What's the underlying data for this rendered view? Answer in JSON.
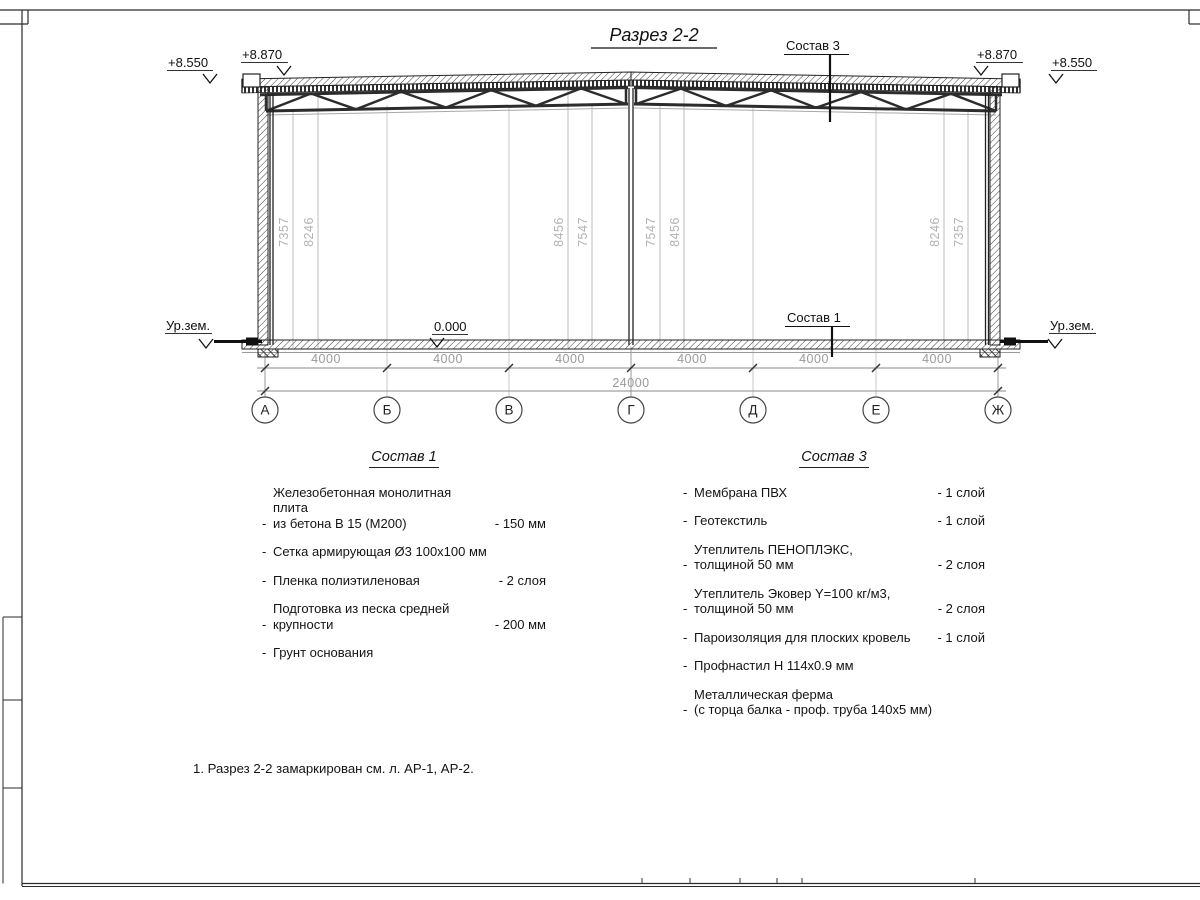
{
  "bullet": "-",
  "title": "Разрез 2-2",
  "note": "1. Разрез 2-2 замаркирован см. л. АР-1, АР-2.",
  "drawing": {
    "callout_roof": "Состав 3",
    "callout_floor": "Состав 1",
    "levels": {
      "left_outer": "+8.550",
      "left_eave": "+8.870",
      "right_eave": "+8.870",
      "right_outer": "+8.550",
      "floor": "0.000",
      "ground_left": "Ур.зем.",
      "ground_right": "Ур.зем."
    },
    "vertical_dims": [
      "7357",
      "8246",
      "8456",
      "7547",
      "7547",
      "8456",
      "8246",
      "7357"
    ],
    "bay_dims": [
      "4000",
      "4000",
      "4000",
      "4000",
      "4000",
      "4000"
    ],
    "total_dim": "24000",
    "axes": [
      "А",
      "Б",
      "В",
      "Г",
      "Д",
      "Е",
      "Ж"
    ]
  },
  "spec1": {
    "heading": "Состав 1",
    "items": [
      {
        "name": "Железобетонная  монолитная плита\nиз бетона В 15 (М200)",
        "value": "- 150 мм"
      },
      {
        "name": "Сетка армирующая Ø3 100х100 мм",
        "value": ""
      },
      {
        "name": "Пленка полиэтиленовая",
        "value": "- 2 слоя"
      },
      {
        "name": "Подготовка из песка средней\nкрупности",
        "value": "- 200 мм"
      },
      {
        "name": "Грунт основания",
        "value": ""
      }
    ]
  },
  "spec3": {
    "heading": "Состав 3",
    "items": [
      {
        "name": "Мембрана ПВХ",
        "value": "- 1 слой"
      },
      {
        "name": "Геотекстиль",
        "value": "- 1 слой"
      },
      {
        "name": "Утеплитель ПЕНОПЛЭКС,\nтолщиной 50 мм",
        "value": "- 2 слоя"
      },
      {
        "name": "Утеплитель Эковер Y=100 кг/м3,\nтолщиной 50 мм",
        "value": "- 2 слоя"
      },
      {
        "name": "Пароизоляция для плоских кровель",
        "value": "- 1 слой"
      },
      {
        "name": "Профнастил Н 114х0.9 мм",
        "value": ""
      },
      {
        "name": "Металлическая ферма\n(с торца балка - проф. труба 140х5 мм)",
        "value": ""
      }
    ]
  }
}
